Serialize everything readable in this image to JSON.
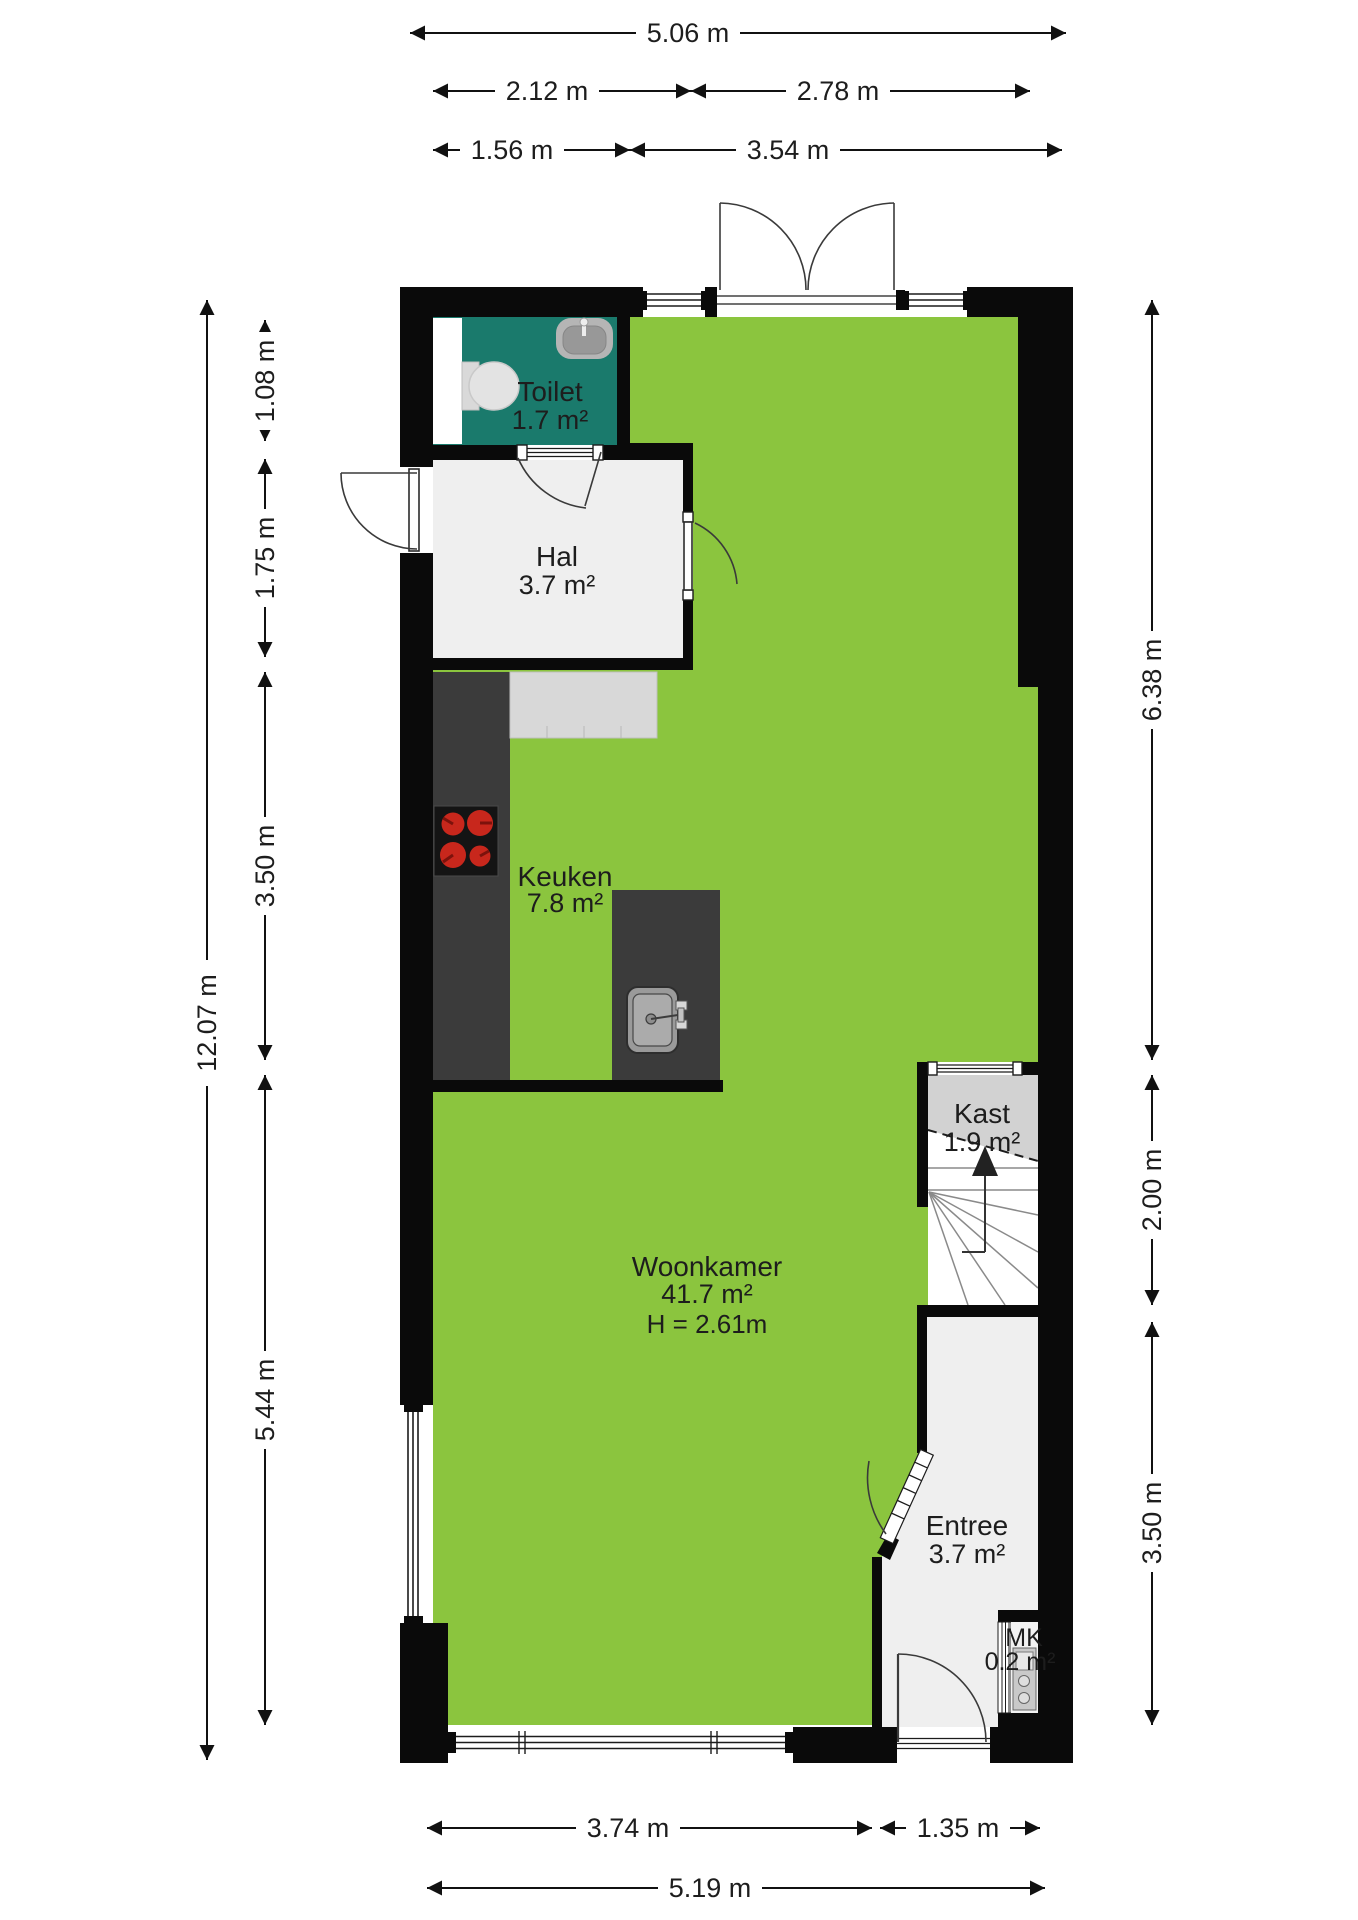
{
  "rooms": {
    "toilet": {
      "name": "Toilet",
      "area": "1.7 m²"
    },
    "hal": {
      "name": "Hal",
      "area": "3.7 m²"
    },
    "keuken": {
      "name": "Keuken",
      "area": "7.8 m²"
    },
    "woonkamer": {
      "name": "Woonkamer",
      "area": "41.7 m²",
      "ceiling_height": "H = 2.61m"
    },
    "kast": {
      "name": "Kast",
      "area": "1.9 m²"
    },
    "entree": {
      "name": "Entree",
      "area": "3.7 m²"
    },
    "mk": {
      "name": "MK",
      "area": "0.2 m²"
    }
  },
  "dimensions": {
    "top": {
      "total": "5.06 m",
      "row2_left": "2.12 m",
      "row2_right": "2.78 m",
      "row3_left": "1.56 m",
      "row3_right": "3.54 m"
    },
    "left": {
      "total": "12.07 m",
      "seg1": "1.08 m",
      "seg2": "1.75 m",
      "seg3": "3.50 m",
      "seg4": "5.44 m"
    },
    "right": {
      "seg1": "6.38 m",
      "seg2": "2.00 m",
      "seg3": "3.50 m"
    },
    "bottom": {
      "row1_left": "3.74 m",
      "row1_right": "1.35 m",
      "total": "5.19 m"
    }
  },
  "colors": {
    "wall_black": "#0A0A0A",
    "floor_green": "#8BC53E",
    "toilet_teal": "#1A7A6C",
    "room_gray": "#EFEFEF",
    "kast_gray": "#D2D2D2",
    "counter_dark": "#3B3B3B",
    "counter_light": "#D8D8D8",
    "burner_red": "#C8271C"
  }
}
